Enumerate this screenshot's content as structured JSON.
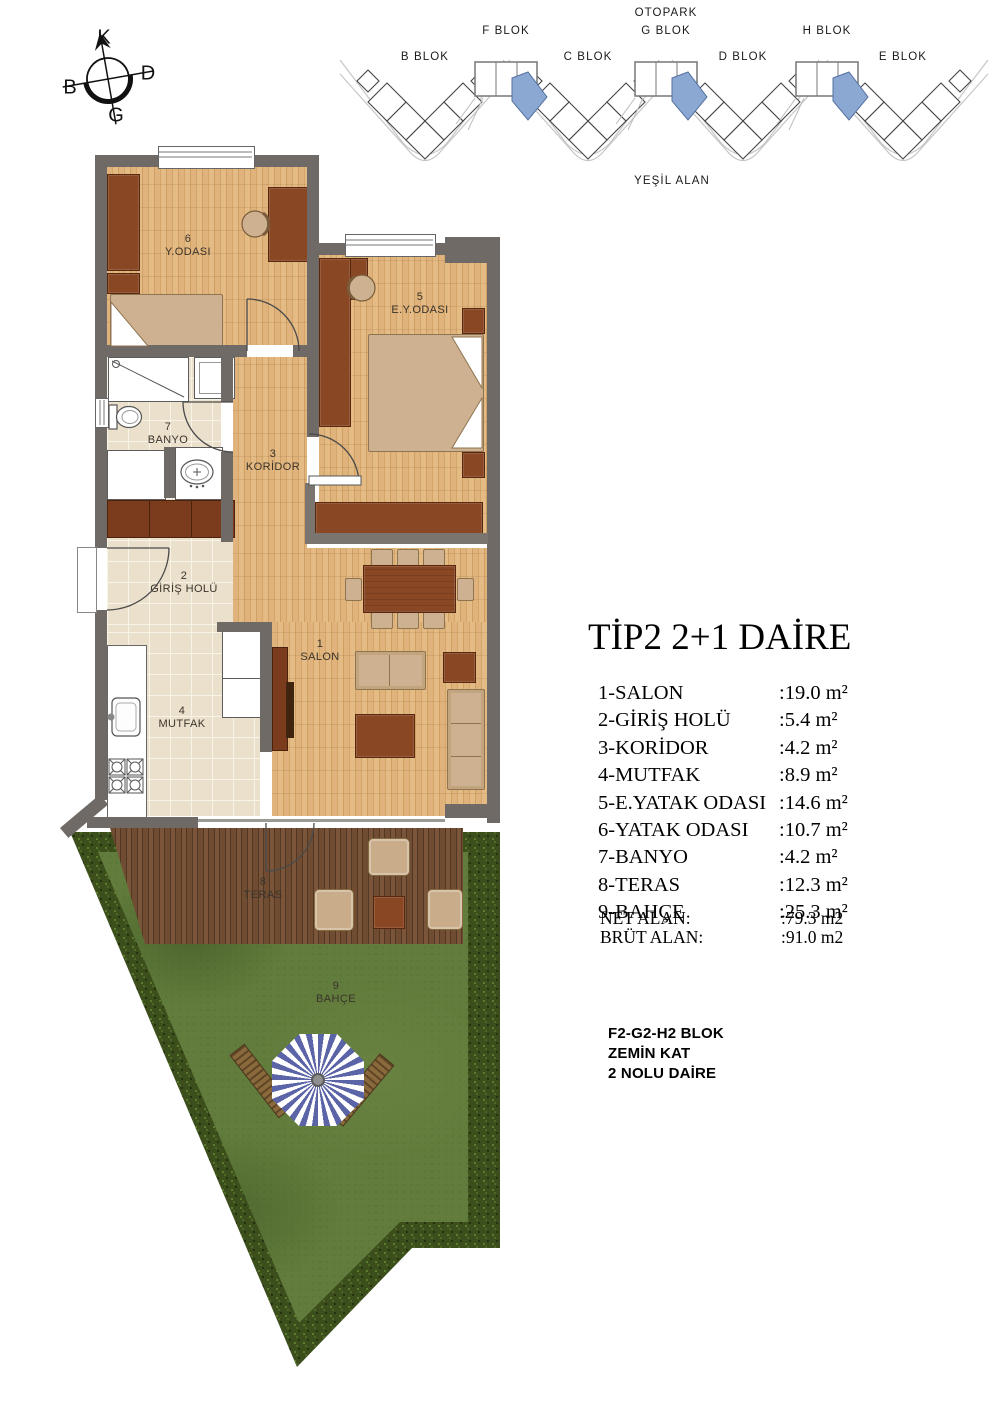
{
  "compass": {
    "north": "K",
    "east": "D",
    "south": "G",
    "west": "B"
  },
  "site_plan": {
    "otopark": "OTOPARK",
    "yesil_alan": "YEŞİL ALAN",
    "f": "F BLOK",
    "g": "G BLOK",
    "h": "H BLOK",
    "b": "B BLOK",
    "c": "C BLOK",
    "d": "D BLOK",
    "e": "E BLOK"
  },
  "rooms": {
    "salon": {
      "num": "1",
      "name": "SALON"
    },
    "giris": {
      "num": "2",
      "name": "GİRİŞ HOLÜ"
    },
    "koridor": {
      "num": "3",
      "name": "KORİDOR"
    },
    "mutfak": {
      "num": "4",
      "name": "MUTFAK"
    },
    "eyodasi": {
      "num": "5",
      "name": "E.Y.ODASI"
    },
    "yodasi": {
      "num": "6",
      "name": "Y.ODASI"
    },
    "banyo": {
      "num": "7",
      "name": "BANYO"
    },
    "teras": {
      "num": "8",
      "name": "TERAS"
    },
    "bahce": {
      "num": "9",
      "name": "BAHÇE"
    }
  },
  "legend": {
    "title": "TİP2 2+1 DAİRE",
    "items": [
      {
        "label": "1-SALON",
        "value": ":19.0 m²"
      },
      {
        "label": "2-GİRİŞ HOLÜ",
        "value": ":5.4 m²"
      },
      {
        "label": "3-KORİDOR",
        "value": ":4.2 m²"
      },
      {
        "label": "4-MUTFAK",
        "value": ":8.9 m²"
      },
      {
        "label": "5-E.YATAK ODASI",
        "value": ":14.6 m²"
      },
      {
        "label": "6-YATAK ODASI",
        "value": ":10.7 m²"
      },
      {
        "label": "7-BANYO",
        "value": ":4.2 m²"
      },
      {
        "label": "8-TERAS",
        "value": ":12.3 m²"
      },
      {
        "label": "9-BAHÇE",
        "value": ":25.3  m²"
      }
    ],
    "totals": [
      {
        "label": "NET ALAN:",
        "value": ":79.3 m2"
      },
      {
        "label": "BRÜT ALAN:",
        "value": ":91.0 m2"
      }
    ],
    "block_info": [
      "F2-G2-H2 BLOK",
      "ZEMİN KAT",
      "2 NOLU DAİRE"
    ]
  },
  "colors": {
    "wall": "#6f6a65",
    "wood": "#dfb37b",
    "tile": "#ebe0cb",
    "deck": "#6f4c32",
    "grass": "#617c3c",
    "hedge": "#3c4e1c",
    "highlight_blue": "#8ba8d3",
    "furniture_brown": "#8a4724"
  }
}
